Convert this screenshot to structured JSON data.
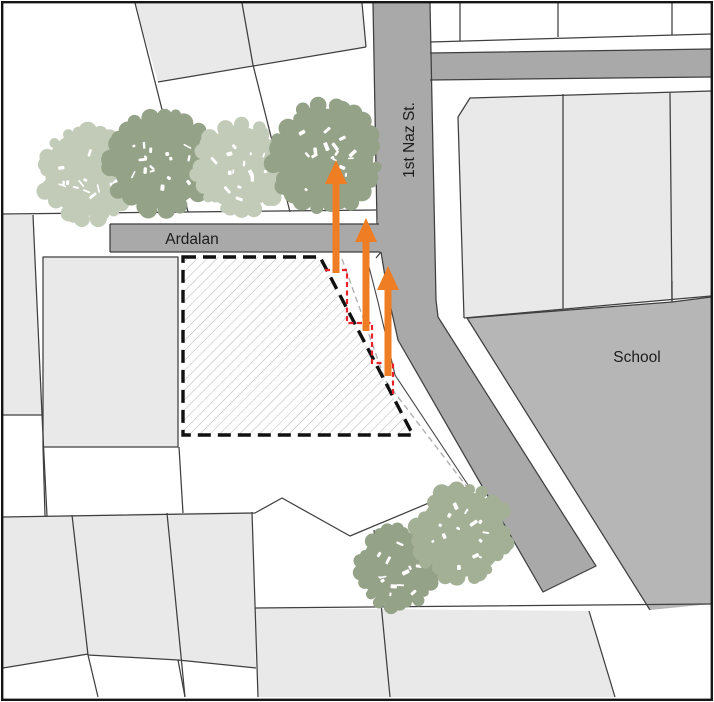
{
  "map": {
    "title": "site plan map",
    "street_vertical": {
      "label": "1st Naz St."
    },
    "street_horizontal": {
      "label": "Ardalan"
    },
    "school": {
      "label": "School"
    },
    "site": {
      "fill": "diagonal-hatch",
      "boundary_style": "black-dashed",
      "setback_line_style": "red-dashed-steps"
    },
    "setback_arrows": {
      "count": 3,
      "direction": "up",
      "items": [
        {
          "x": 336,
          "tail_y": 273,
          "tip_y": 160
        },
        {
          "x": 366,
          "tail_y": 331,
          "tip_y": 218
        },
        {
          "x": 388,
          "tail_y": 376,
          "tip_y": 266
        }
      ]
    },
    "trees": {
      "top_row_count": 4,
      "bottom_count": 2,
      "items": [
        {
          "cx": 88,
          "cy": 173,
          "r": 46,
          "shade": "light"
        },
        {
          "cx": 160,
          "cy": 162,
          "r": 50,
          "shade": "dark"
        },
        {
          "cx": 240,
          "cy": 168,
          "r": 44,
          "shade": "light"
        },
        {
          "cx": 325,
          "cy": 157,
          "r": 52,
          "shade": "dark"
        },
        {
          "cx": 398,
          "cy": 568,
          "r": 40,
          "shade": "dark"
        },
        {
          "cx": 462,
          "cy": 534,
          "r": 46,
          "shade": "medium"
        }
      ]
    },
    "colors": {
      "street": "#a9a9a9",
      "school": "#b6b6b6",
      "parcel": "#e9e9e9",
      "parcel_outline": "#3f3f3f",
      "site_outline": "#111111",
      "hatch": "#b9b9b9",
      "offset_dash_gray": "#b0b0b0",
      "setback_red": "#e8212b",
      "arrow_orange": "#ef7d23",
      "tree_light": "#c2cbb8",
      "tree_dark": "#94a287",
      "tree_medium": "#a3b095"
    }
  }
}
